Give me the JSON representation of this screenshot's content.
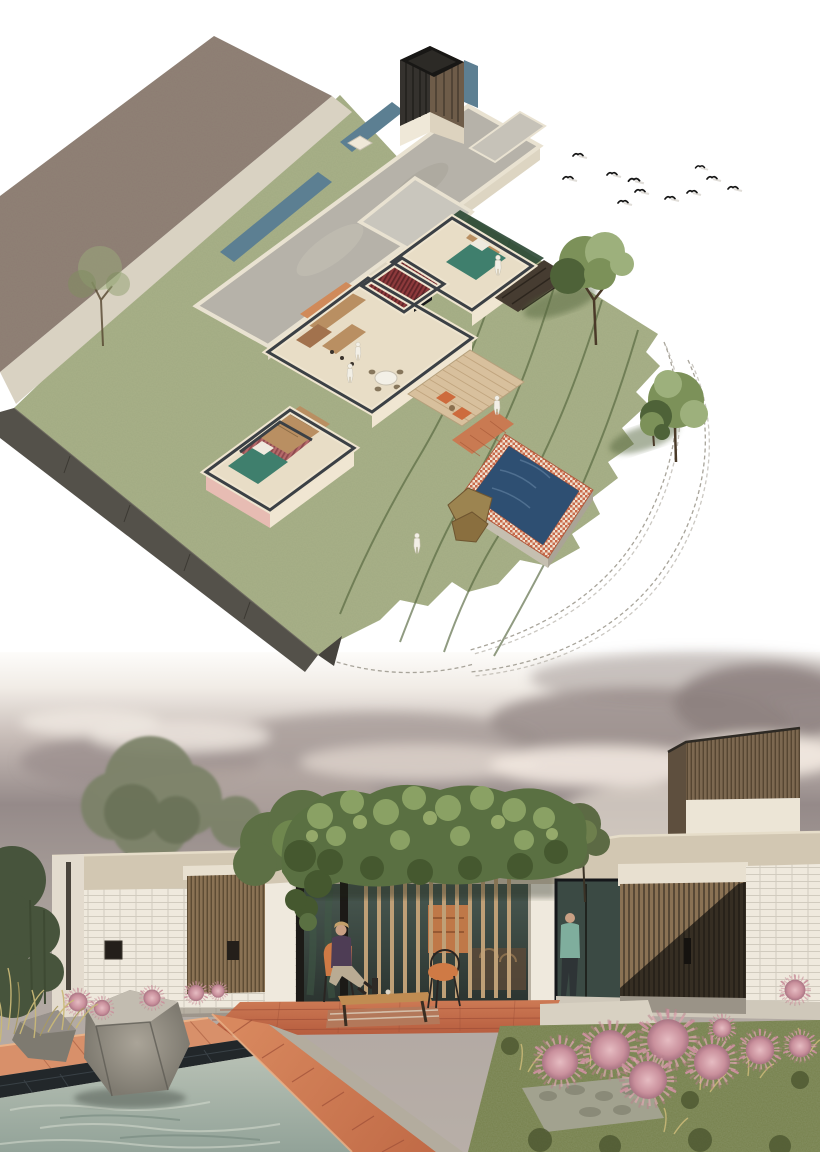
{
  "page": {
    "width": 820,
    "height": 1160,
    "background": "#ffffff",
    "kind": "architectural-presentation-board"
  },
  "colors": {
    "paper": "#ffffff",
    "lawn": "#a9b188",
    "lawn_dark": "#6b754d",
    "contour": "#55663e",
    "sketch": "#a8a49a",
    "neighbor_roof": "#8d7b73",
    "gravel": "#d9d2c2",
    "channel": "#5c7f92",
    "slab": "#b6b2a9",
    "slab_edge": "#e9e2d1",
    "slab2": "#c9c6bd",
    "wall": "#efe5d0",
    "wall_cut": "#3b4045",
    "floor": "#e8ddc6",
    "red_room": "#8e3a3c",
    "red_stripe": "#5f2528",
    "pink_room": "#b56a6a",
    "pink_wall": "#e7bcb3",
    "teal": "#3f7f6d",
    "wood": "#b98f62",
    "orange": "#d08a5a",
    "deck": "#d8c09d",
    "deck_line": "#bda17a",
    "pool_iso": "#2e4f72",
    "pool_trim": "#c96a4a",
    "rock_tan": "#9c8450",
    "edge_wall": "#54514a",
    "tower_dark": "#35322e",
    "tower_wood": "#6e5c49",
    "tree": "#7c9159",
    "tree_dark": "#4e6238",
    "tree_light": "#9db07c",
    "r_tree": "#5d7045",
    "r_tree_muted": "#7b8268",
    "bush_dark": "#47543c",
    "vine": "#5a7042",
    "vine_light": "#8aa164",
    "vine_dark": "#45582f",
    "parapet": "#d2c7b2",
    "brickw": "#efe9dd",
    "brick_shadow": "#d8d1c5",
    "slatwood": "#8a7254",
    "slatwood_dark": "#55452f",
    "tower_slat": "#7c6850",
    "charcoal": "#2f2a23",
    "glass": "#3b4a44",
    "glass_hi": "#6d8577",
    "terra": "#c26b4e",
    "terra_light": "#d98f68",
    "terra_dark": "#9e4f38",
    "poolw": "#a9b7ac",
    "pool_tile": "#22272a",
    "concrete": "#cfc8ba",
    "concrete_dark": "#b3ac9e",
    "rock": "#8e8880",
    "rock_dark": "#5f5c55",
    "rock_light": "#c2bcb0",
    "pink": "#c9909c",
    "pink_light": "#e6bcc2",
    "garden": "#76804b",
    "garden_dark": "#4c5630",
    "dry": "#c9b877",
    "stone": "#a2a28f",
    "skin": "#c9a084",
    "woman": "#4e3d55",
    "pants": "#b9ab93",
    "man": "#7fae9d",
    "post": "#bfa077",
    "lintel": "#e8e0d0"
  },
  "isometric_plan": {
    "name": "isometric-site-plan",
    "features": [
      "neighbor-roof-plane",
      "gravel-path",
      "water-channel",
      "concrete-roof-slab",
      "timber-tower",
      "flat-roof",
      "cutaway-floor-plan",
      "kitchen",
      "dining-table",
      "living-sofa",
      "bathroom",
      "bedrooms",
      "timber-deck",
      "swimming-pool",
      "pool-rocks",
      "lawn",
      "contour-lines",
      "sketched-contours",
      "trees",
      "birds"
    ],
    "counts": {
      "birds": 11,
      "trees": 4,
      "people": 5
    }
  },
  "exterior_render": {
    "name": "exterior-visualization",
    "features": [
      "overcast-sky",
      "timber-slat-tower",
      "white-brick-walls",
      "timber-slat-doors",
      "vine-covered-pergola",
      "glass-walls",
      "terracotta-patio",
      "swimming-pool",
      "boulders",
      "pink-seedhead-plants",
      "ornamental-garden",
      "outdoor-furniture"
    ],
    "counts": {
      "people": 2,
      "pink_plants": 14
    }
  }
}
